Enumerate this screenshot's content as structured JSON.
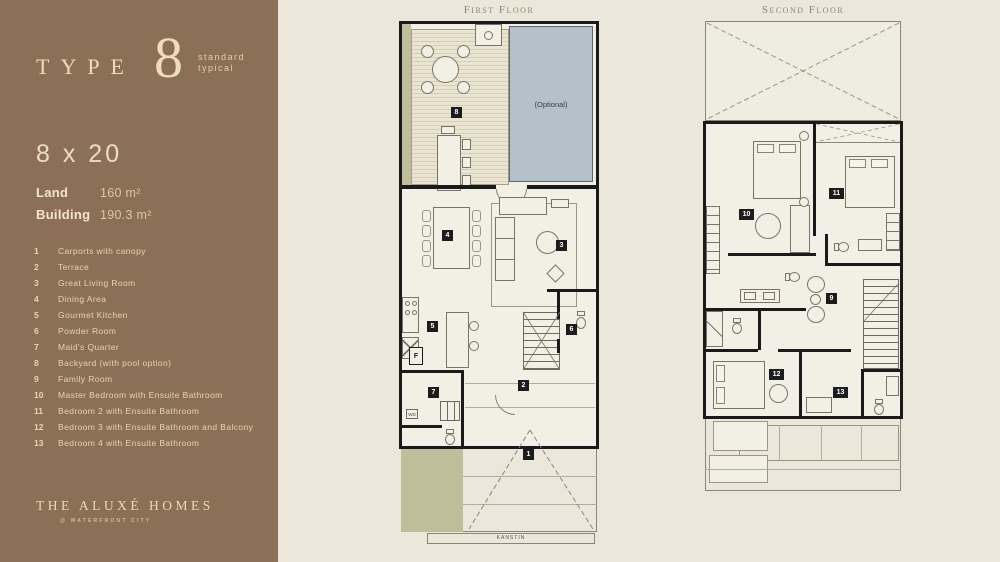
{
  "colors": {
    "sidebar_brown": "#8b7057",
    "cream_text": "#eedcbc",
    "page_background": "#ebe8db",
    "plan_floor": "#f2efe4",
    "wall_black": "#1a1a1a",
    "pool_blue": "#b5c1c9",
    "deck_beige": "#eae5d3",
    "planter_olive": "#c0bd9b"
  },
  "sidebar": {
    "type_word": "TYPE",
    "type_number": "8",
    "type_sub_line1": "standard",
    "type_sub_line2": "typical",
    "dimensions": "8 x 20",
    "land_label": "Land",
    "land_value": "160 m²",
    "building_label": "Building",
    "building_value": "190.3 m²",
    "legend": [
      {
        "n": "1",
        "label": "Carports with canopy"
      },
      {
        "n": "2",
        "label": "Terrace"
      },
      {
        "n": "3",
        "label": "Great Living Room"
      },
      {
        "n": "4",
        "label": "Dining Area"
      },
      {
        "n": "5",
        "label": "Gourmet Kitchen"
      },
      {
        "n": "6",
        "label": "Powder Room"
      },
      {
        "n": "7",
        "label": "Maid's Quarter"
      },
      {
        "n": "8",
        "label": "Backyard (with pool option)"
      },
      {
        "n": "9",
        "label": "Family Room"
      },
      {
        "n": "10",
        "label": "Master Bedroom with Ensuite Bathroom"
      },
      {
        "n": "11",
        "label": "Bedroom 2 with Ensuite Bathroom"
      },
      {
        "n": "12",
        "label": "Bedroom 3 with Ensuite Bathroom and Balcony"
      },
      {
        "n": "13",
        "label": "Bedroom 4 with Ensuite Bathroom"
      }
    ],
    "brand": "THE ALUXÉ HOMES",
    "brand_sub": "@ WATERFRONT CITY"
  },
  "first_floor": {
    "title": "First Floor",
    "pool_label": "(Optional)",
    "curb_label": "KANSTIN",
    "washer_label": "WD",
    "fridge_label": "F",
    "badges": {
      "backyard": "8",
      "dining": "4",
      "living": "3",
      "kitchen": "5",
      "powder": "6",
      "maid": "7",
      "terrace": "2",
      "carport": "1"
    }
  },
  "second_floor": {
    "title": "Second Floor",
    "badges": {
      "master_bedroom": "10",
      "bedroom2": "11",
      "family": "9",
      "bedroom3": "12",
      "bedroom4": "13"
    }
  }
}
